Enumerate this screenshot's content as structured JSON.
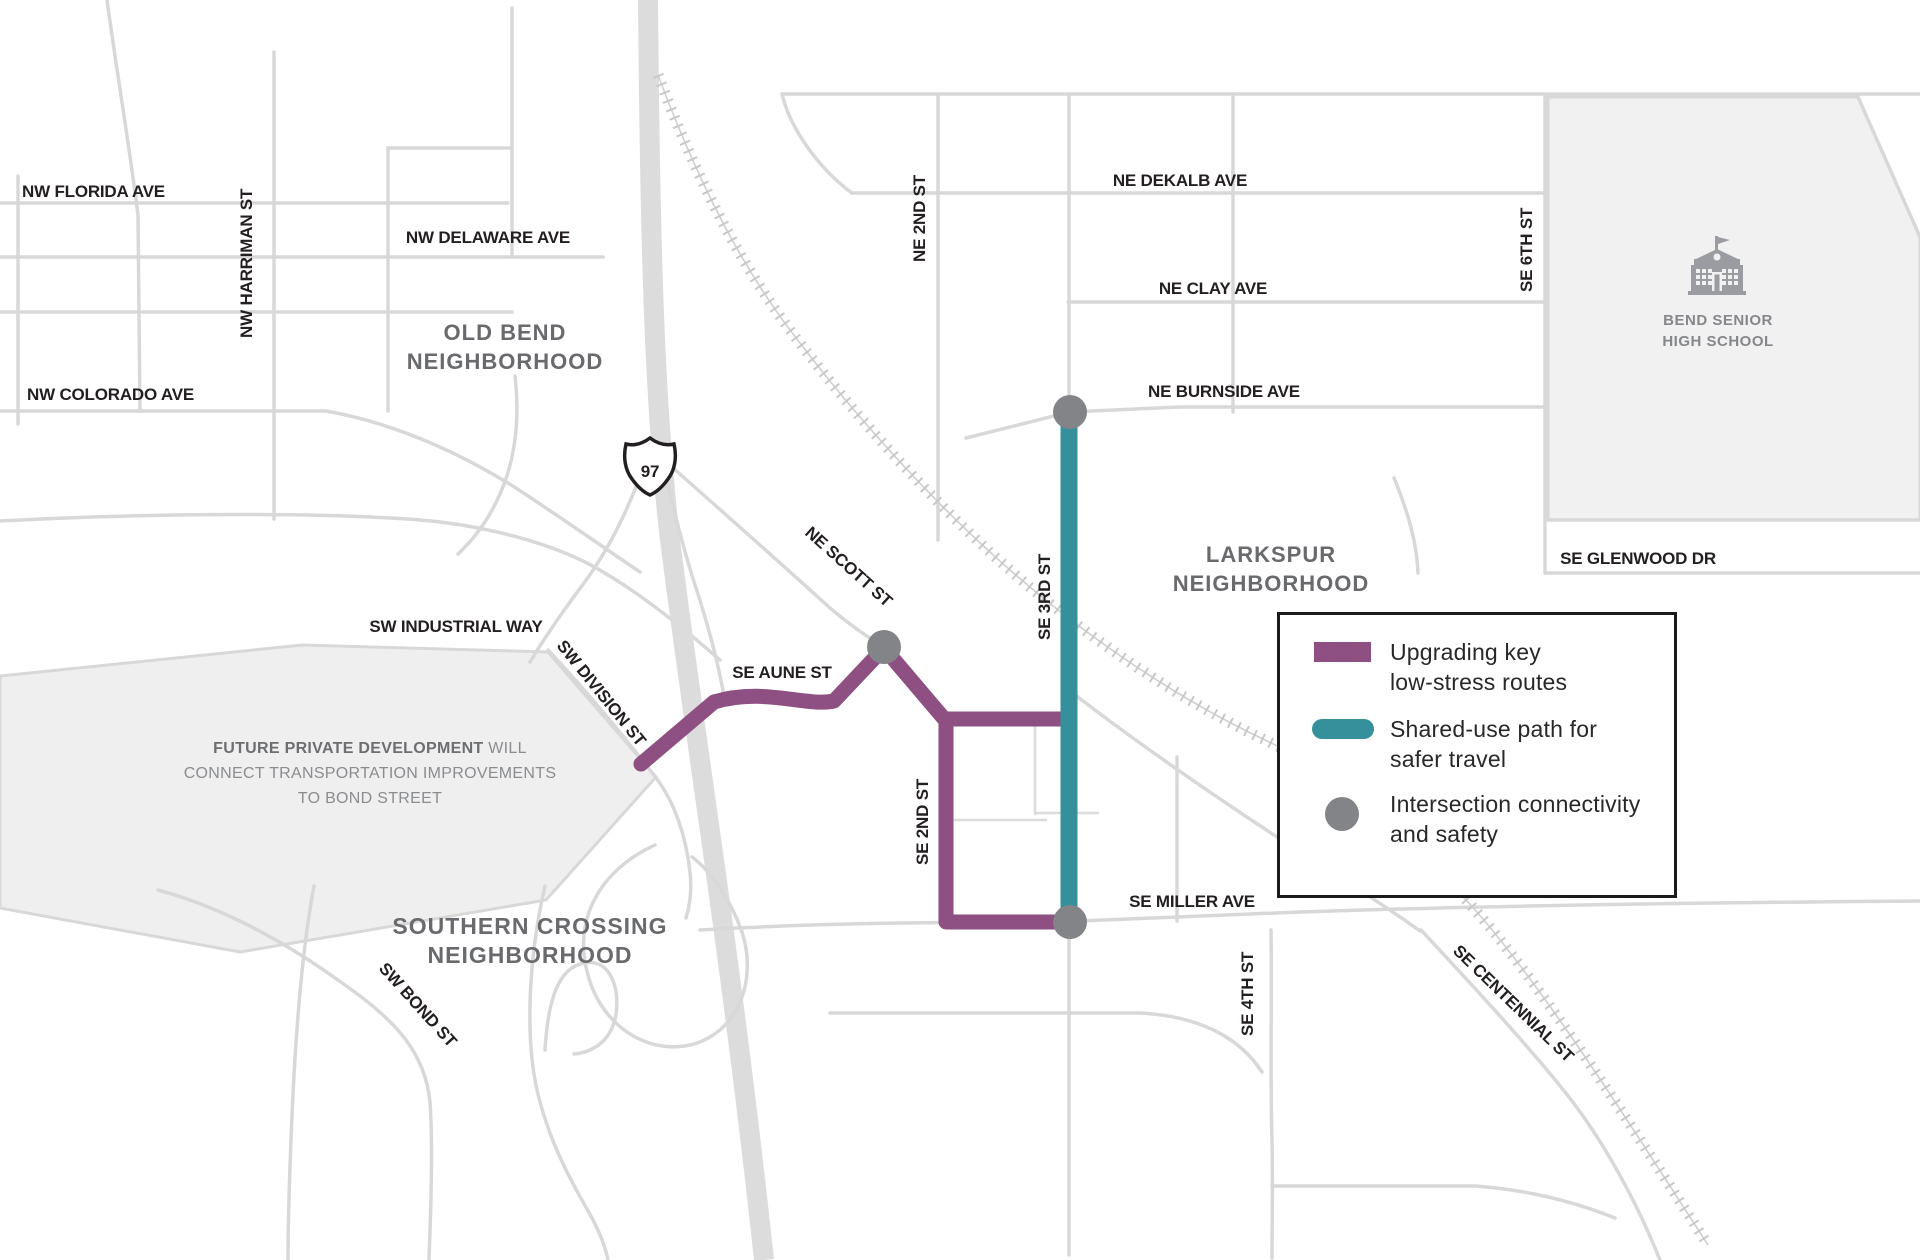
{
  "colors": {
    "upgrade_route": "#8e4f82",
    "shared_use_path": "#35909b",
    "intersection_dot": "#828487",
    "road": "#d8d8d8",
    "highway": "#dcdcdc",
    "area_fill": "#efefef",
    "street_label": "#231f20",
    "neighborhood_label": "#696a6d"
  },
  "highway_shield": {
    "number": "97"
  },
  "streets": {
    "nw_florida": "NW FLORIDA AVE",
    "nw_harriman": "NW HARRIMAN ST",
    "nw_delaware": "NW DELAWARE  AVE",
    "nw_colorado": "NW COLORADO AVE",
    "ne_scott": "NE SCOTT ST",
    "sw_industrial": "SW INDUSTRIAL WAY",
    "sw_division": "SW DIVISION ST",
    "se_aune": "SE AUNE  ST",
    "ne_2nd": "NE 2ND ST",
    "se_2nd": "SE 2ND ST",
    "ne_dekalb": "NE DEKALB AVE",
    "ne_clay": "NE CLAY AVE",
    "ne_burnside": "NE BURNSIDE AVE",
    "se_3rd": "SE 3RD ST",
    "se_6th": "SE 6TH ST",
    "se_glenwood": "SE GLENWOOD DR",
    "se_miller": "SE MILLER AVE",
    "se_4th": "SE 4TH ST",
    "se_centennial": "SE CENTENNIAL ST",
    "sw_bond": "SW BOND ST"
  },
  "neighborhoods": {
    "old_bend": {
      "line1": "OLD BEND",
      "line2": "NEIGHBORHOOD"
    },
    "larkspur": {
      "line1": "LARKSPUR",
      "line2": "NEIGHBORHOOD"
    },
    "southern_crossing": {
      "line1": "SOUTHERN CROSSING",
      "line2": "NEIGHBORHOOD"
    }
  },
  "school": {
    "line1": "BEND SENIOR",
    "line2": "HIGH SCHOOL"
  },
  "future_development_note": {
    "line1_bold": "FUTURE PRIVATE DEVELOPMENT",
    "line1_rest": " WILL",
    "line2": "CONNECT TRANSPORTATION IMPROVEMENTS",
    "line3": "TO BOND STREET"
  },
  "legend": {
    "items": [
      {
        "symbol": "upgrade-route-swatch",
        "lines": [
          "Upgrading key",
          "low-stress routes"
        ]
      },
      {
        "symbol": "shared-use-path-swatch",
        "lines": [
          "Shared-use path for",
          "safer travel"
        ]
      },
      {
        "symbol": "intersection-dot",
        "lines": [
          "Intersection connectivity",
          "and safety"
        ]
      }
    ]
  }
}
